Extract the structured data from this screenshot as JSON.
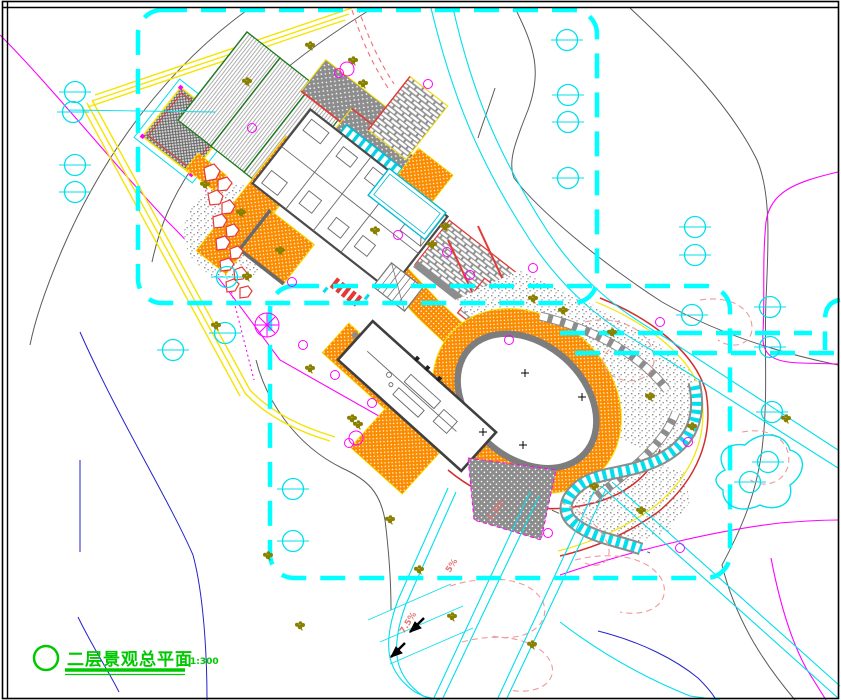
{
  "drawing": {
    "title": "二层景观总平面",
    "scale": "1:300",
    "slope_labels": [
      {
        "text": "7.5%"
      },
      {
        "text": "5%"
      },
      {
        "text": "7.5%"
      }
    ],
    "colors": {
      "boundary_cyan": "#00ffff",
      "road_cyan": "#00dfee",
      "paving_orange": "#fb8c00",
      "title_green": "#00c800",
      "rock_red": "#e53935",
      "contour_gray": "#5a5a5a",
      "survey_magenta": "#ff00ff",
      "contour_blue": "#2323cc",
      "planting_pink": "#ef9a9a",
      "shrub_olive": "#8a8000",
      "road_yellow": "#f5e400",
      "wall_gray": "#555555"
    },
    "symbols": {
      "existing_tree": "circle-with-bar-icon",
      "shrub": "olive-cluster-icon",
      "ornamental_tree": "magenta-circle-icon",
      "rockery": "red-polygon-icon",
      "stream": "cyan-ladder-band",
      "stepping_stones": "white-stone-path"
    }
  }
}
